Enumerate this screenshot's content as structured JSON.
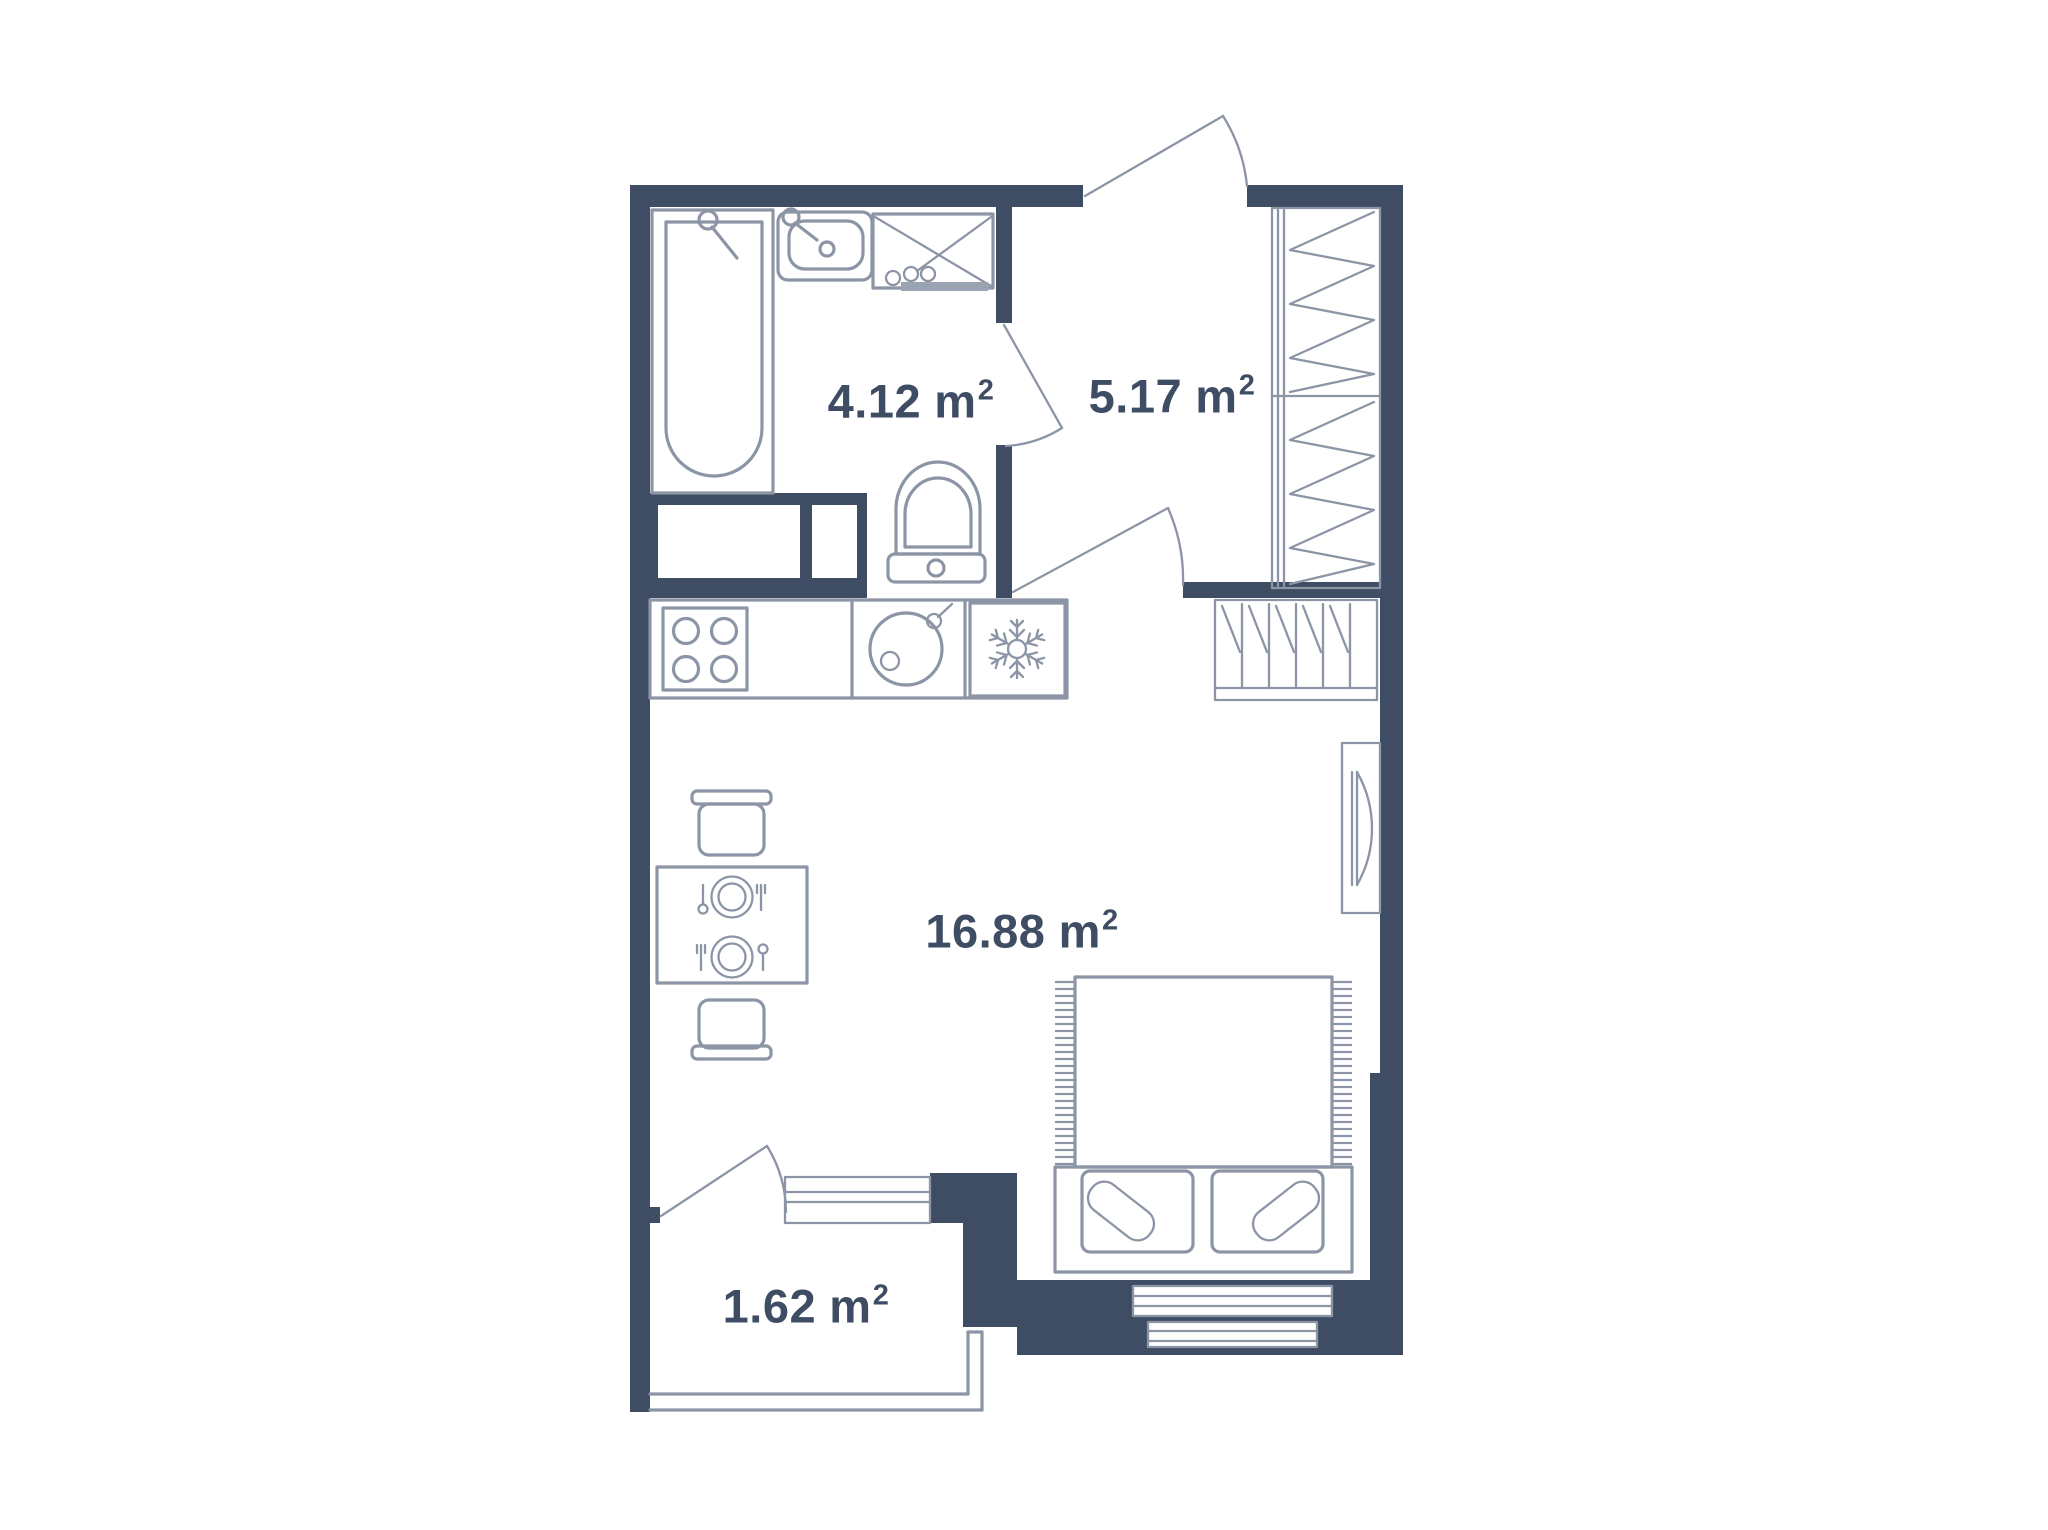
{
  "document": {
    "kind": "apartment-floor-plan",
    "background_color": "#FFFFFF"
  },
  "colors": {
    "wall": "#3E4D63",
    "fixture_line": "#8C95A5",
    "label_text": "#3E4D63",
    "accent_fill": "#9AA3B2"
  },
  "rooms": [
    {
      "key": "bathroom",
      "area": "4.12",
      "unit": "m",
      "sup": "2"
    },
    {
      "key": "hallway",
      "area": "5.17",
      "unit": "m",
      "sup": "2"
    },
    {
      "key": "living_room",
      "area": "16.88",
      "unit": "m",
      "sup": "2"
    },
    {
      "key": "balcony",
      "area": "1.62",
      "unit": "m",
      "sup": "2"
    }
  ],
  "fixtures": [
    "bathtub-icon",
    "bathroom-sink-icon",
    "washing-machine-icon",
    "toilet-icon",
    "stove-icon",
    "kitchen-sink-icon",
    "fridge-snowflake-icon",
    "dining-table-icon",
    "chair-icon",
    "double-bed-icon",
    "pillow-icon",
    "wardrobe-icon",
    "shoe-rack-icon",
    "radiator-icon",
    "entrance-door-icon",
    "bathroom-door-icon",
    "interior-door-icon",
    "balcony-door-icon",
    "french-window-icon",
    "window-icon",
    "balcony-railing"
  ]
}
